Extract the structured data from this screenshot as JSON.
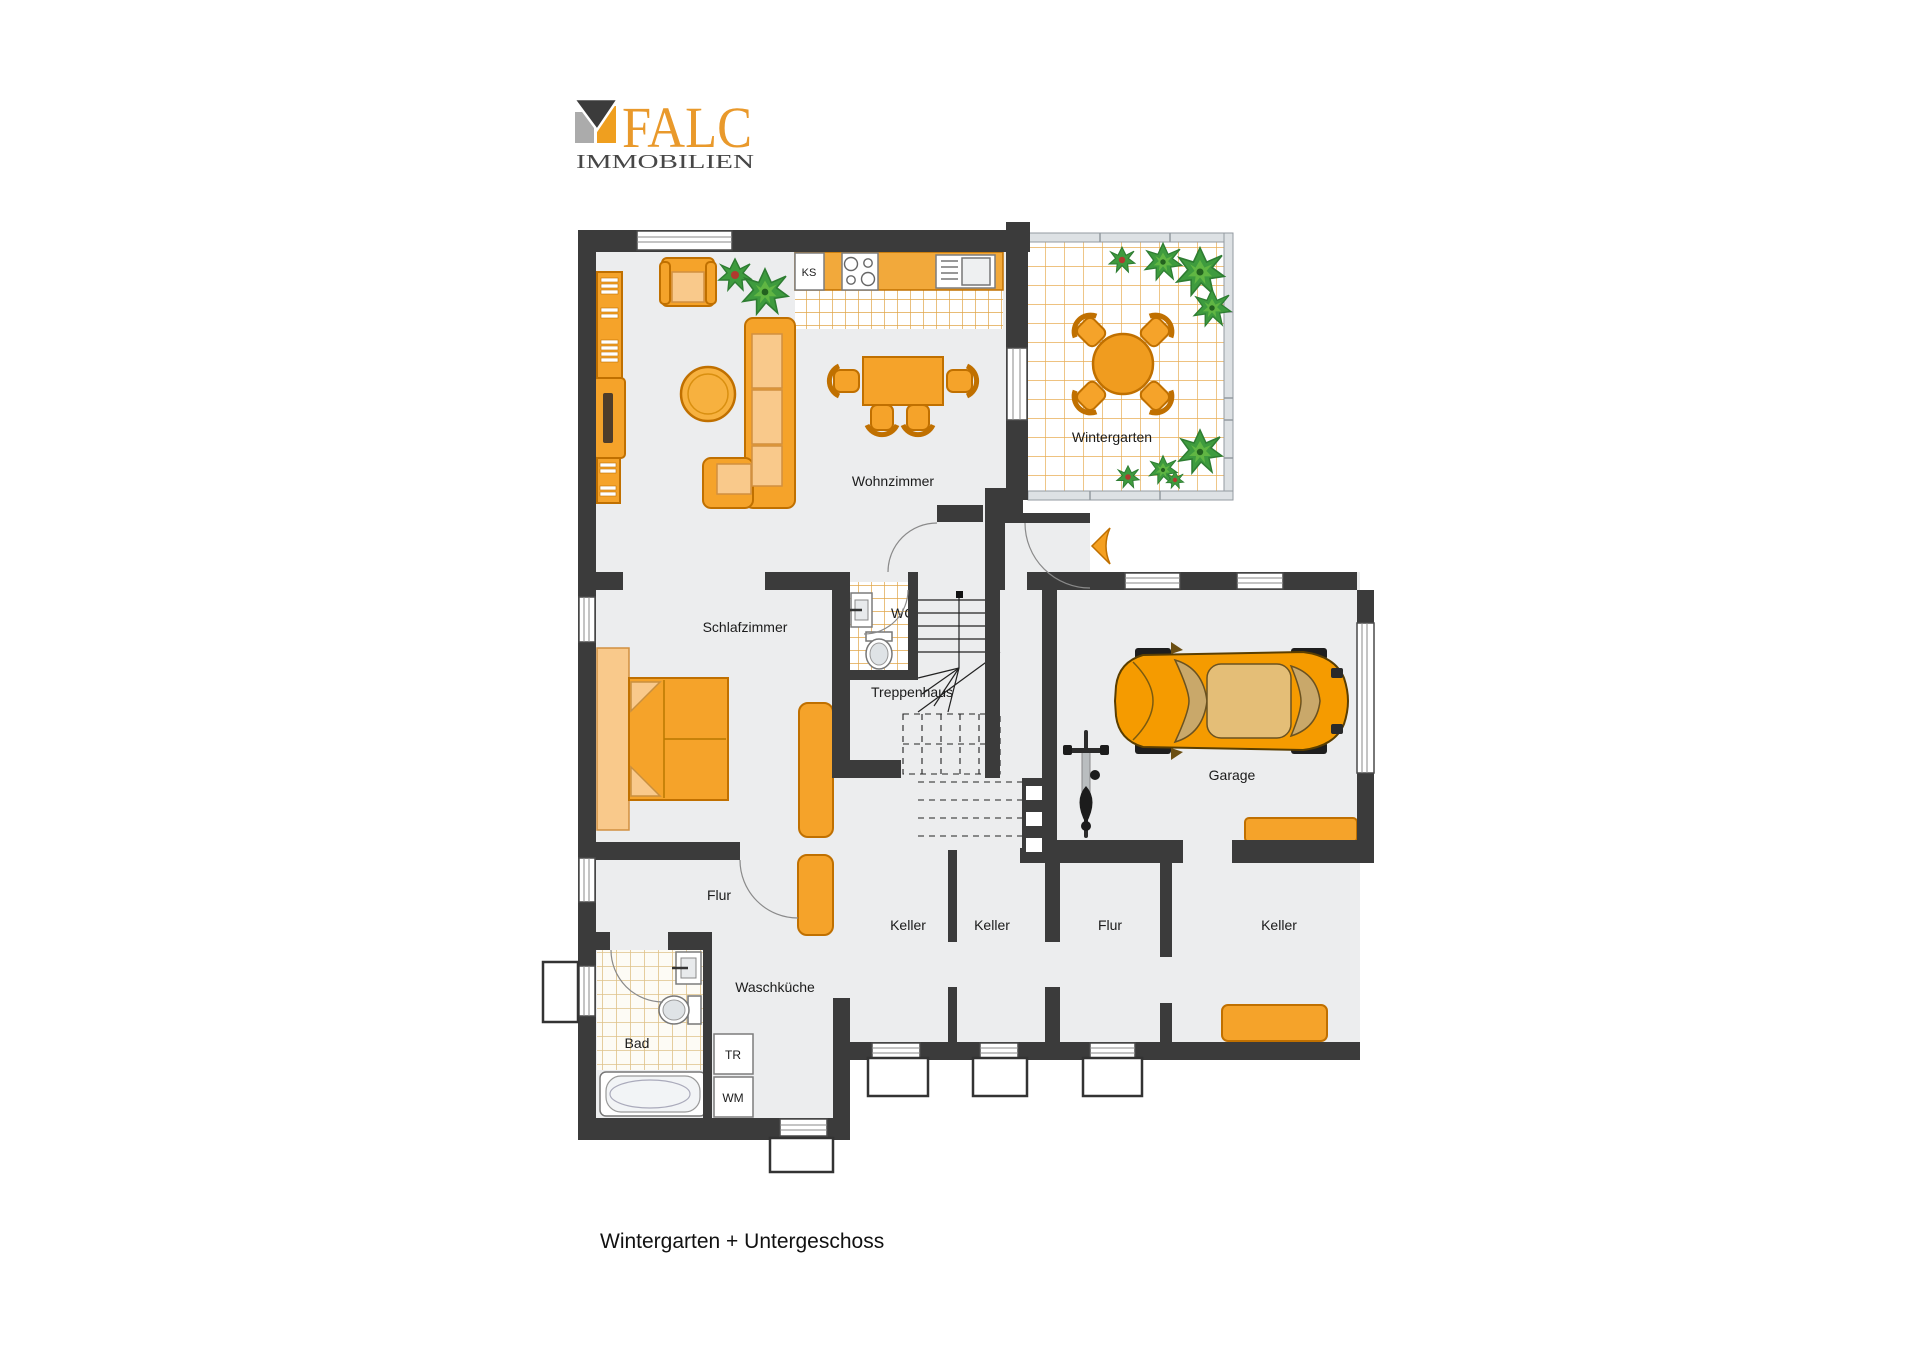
{
  "header": {
    "brand": "FALC",
    "brand_sub": "IMMOBILIEN"
  },
  "caption": "Wintergarten + Untergeschoss",
  "rooms": {
    "wohnzimmer": "Wohnzimmer",
    "wintergarten": "Wintergarten",
    "schlafzimmer": "Schlafzimmer",
    "wc": "WC",
    "treppenhaus": "Treppenhaus",
    "garage": "Garage",
    "flur_upper": "Flur",
    "keller_1": "Keller",
    "keller_2": "Keller",
    "flur_lower": "Flur",
    "keller_3": "Keller",
    "waschkueche": "Waschküche",
    "bad": "Bad"
  },
  "appliances": {
    "fridge": "KS",
    "dryer": "TR",
    "washer": "WM"
  },
  "colors": {
    "wall": "#3B3B3B",
    "floor": "#ECEDEE",
    "furniture_orange": "#F5A32A",
    "furniture_outline": "#C07000",
    "kitchen_tile_line": "#E0A648",
    "bath_tile_line": "#DFC289",
    "glass_wall": "#DDE1E4",
    "plant_green": "#3E9B3E",
    "car_orange": "#F59B00",
    "logo_orange": "#E9992B",
    "logo_gray": "#ABABAB",
    "text": "#1B1B1B"
  }
}
